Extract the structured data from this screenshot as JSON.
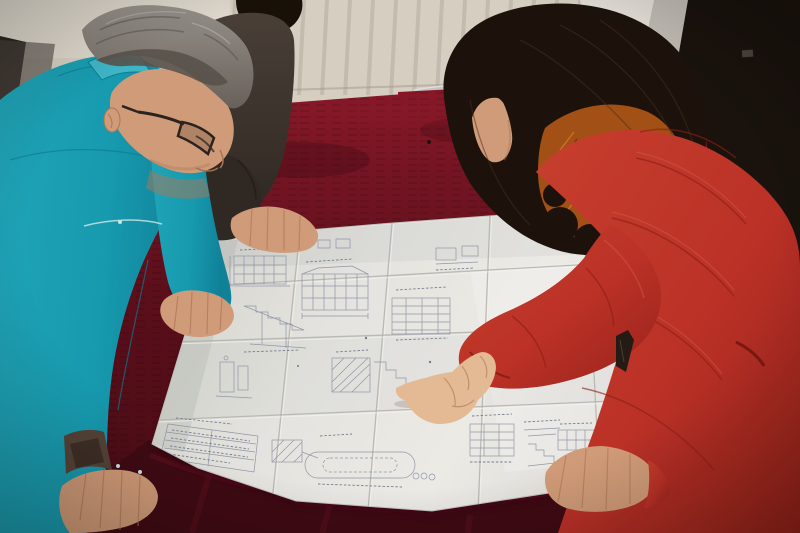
{
  "scene": {
    "type": "photograph",
    "description": "Two colleagues lean over a large folded engineering blueprint spread on a dark red velvet covered table in a room with a white radiator and a dark door.",
    "people": [
      {
        "id": "engineer",
        "label": "man with gray hair and glasses wearing a teal work jacket, leaning over the drawing"
      },
      {
        "id": "colleague",
        "label": "person in a dark jacket standing behind the man, one hand resting on the drawing"
      },
      {
        "id": "woman",
        "label": "woman with long dark hair in a red down coat with orange fur trim, pointing at the drawing"
      }
    ],
    "objects": [
      {
        "id": "blueprint",
        "label": "large folded white engineering drawing sheet with elevations, stair sections, schedules and a title block"
      },
      {
        "id": "table",
        "label": "table draped in dark crimson velvet"
      },
      {
        "id": "radiator",
        "label": "white column radiator on the back wall"
      },
      {
        "id": "door",
        "label": "dark door with pale gray frame at the right"
      },
      {
        "id": "chair",
        "label": "red chair with chrome frame behind the table"
      }
    ]
  },
  "palette": {
    "wall_light": "#ded9cc",
    "wall_bright": "#eae6dc",
    "wall_shadow": "#b7b1a3",
    "wall_dark": "#4e4a44",
    "door_white": "#ebe8e0",
    "door_frame": "#c6c3bb",
    "door_dark": "#18120e",
    "chrome": "#c8ccce",
    "chair_red": "#8e1324",
    "velvet": "#5e0f1d",
    "velvet_light": "#7c1527",
    "velvet_bright": "#8e1a2c",
    "velvet_dark": "#400a14",
    "paper": "#eeefeb",
    "paper_shade": "#c9ccc6",
    "paper_bright": "#f9f9f6",
    "ink": "#8d96aa",
    "ink_dark": "#6e7890",
    "jacket_teal": "#16a1b8",
    "jacket_dark": "#0c7f96",
    "jacket_light": "#44c2d4",
    "piping": "#cfeef2",
    "cuff_brown": "#57463a",
    "cuff_dark": "#3a2e26",
    "hair_gray": "#8b8781",
    "hair_gray_dark": "#5a554f",
    "hair_gray_light": "#bab6b0",
    "skin": "#d9a37f",
    "skin_dark": "#b37b5b",
    "skin_light": "#ecc39c",
    "p2_jacket": "#453e37",
    "p2_dark": "#2f2a25",
    "p2_hair": "#171108",
    "w_hair": "#1b120c",
    "w_hair_hi": "#47321f",
    "fur": "#a85417",
    "fur_light": "#d8862c",
    "fur_dark": "#60300e",
    "coat": "#c23329",
    "coat_dark": "#8f1f18",
    "coat_light": "#de5c48",
    "coat_deep": "#6f1510",
    "zipper": "#251b16"
  }
}
